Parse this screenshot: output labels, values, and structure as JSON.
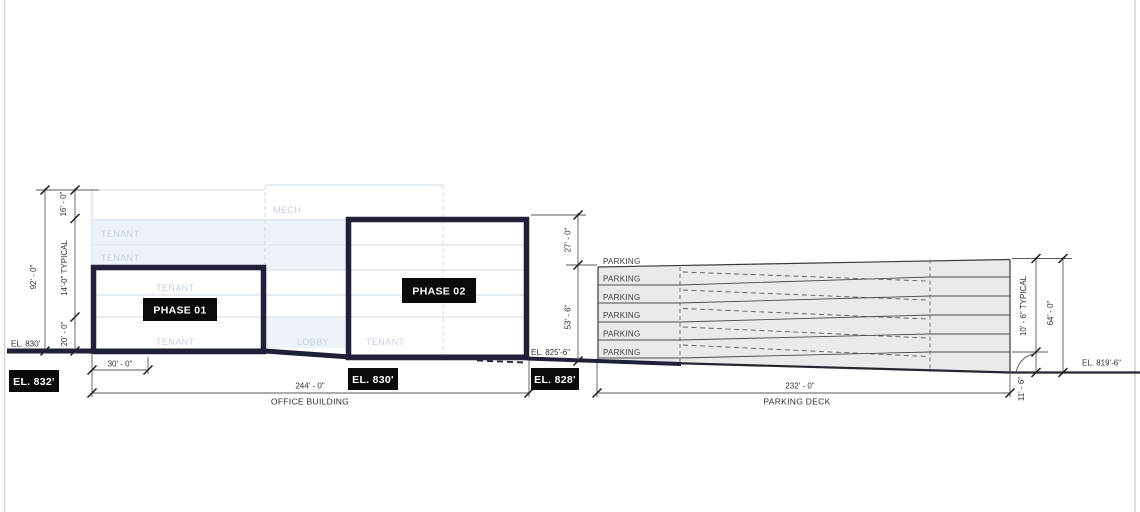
{
  "office": {
    "section_label": "OFFICE BUILDING",
    "width_dim": "244' - 0\"",
    "left_offset_dim": "30' - 0\"",
    "phase1": "PHASE 01",
    "phase2": "PHASE 02",
    "mech": "MECH",
    "tenant": "TENANT",
    "lobby": "LOBBY",
    "height_total": "92' - 0\"",
    "height_top": "16' - 0\"",
    "height_typical": "14'-0\" TYPICAL",
    "height_base": "20' - 0\"",
    "phase2_above": "27' - 0\"",
    "phase2_below": "53' - 6\""
  },
  "parking": {
    "section_label": "PARKING DECK",
    "width_dim": "232' - 0\"",
    "levels": [
      "PARKING",
      "PARKING",
      "PARKING",
      "PARKING",
      "PARKING",
      "PARKING"
    ],
    "height_typical": "10' - 6\" TYPICAL",
    "height_total": "64' - 0\"",
    "height_base": "11' - 6\""
  },
  "elevations": {
    "ground_left": "EL. 830'",
    "badge_left": "EL. 832'",
    "badge_mid": "EL. 830'",
    "badge_right": "EL. 828'",
    "deck_base": "EL. 825'-6\"",
    "ground_right": "EL. 819'-6\""
  },
  "colors": {
    "outline_navy": "#20203a",
    "badge_bg": "#0a0a0a",
    "faint_blue": "#c9d4e3",
    "deck_fill": "#e9eaeb",
    "dim_gray": "#3c3c3c"
  }
}
